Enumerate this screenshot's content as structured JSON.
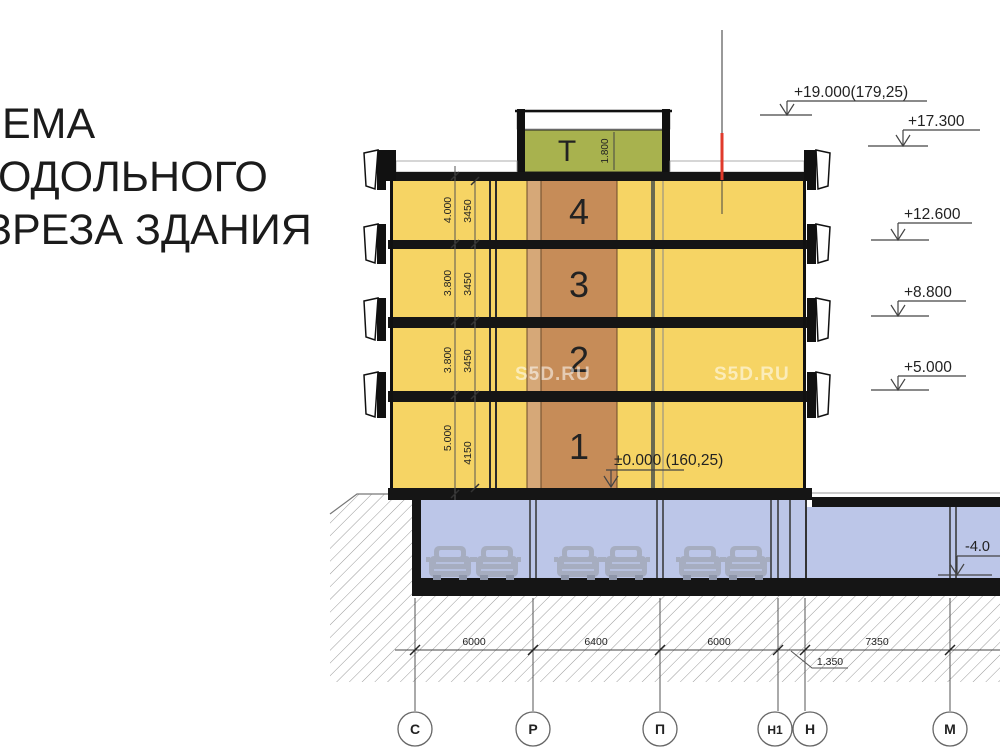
{
  "title": {
    "line1": "ЕМА",
    "line2": "ОДОЛЬНОГО",
    "line3": "ЗРЕЗА ЗДАНИЯ"
  },
  "watermark": {
    "text": "S5D.RU"
  },
  "building": {
    "tech_floor_label": "Т",
    "tech_floor_height": "1.800",
    "floors": [
      {
        "number": "4",
        "height_outer": "4.000",
        "height_inner": "3450"
      },
      {
        "number": "3",
        "height_outer": "3.800",
        "height_inner": "3450"
      },
      {
        "number": "2",
        "height_outer": "3.800",
        "height_inner": "3450"
      },
      {
        "number": "1",
        "height_outer": "5.000",
        "height_inner": "4150"
      }
    ]
  },
  "elevation_marks": {
    "roof_top": "+19.000(179,25)",
    "parapet": "+17.300",
    "level3": "+12.600",
    "level2": "+8.800",
    "level1": "+5.000",
    "ground": "±0.000 (160,25)",
    "basement": "-4.0"
  },
  "axes": {
    "labels": [
      "С",
      "Р",
      "П",
      "Н1",
      "Н",
      "М"
    ]
  },
  "dimensions": {
    "spans": [
      "6000",
      "6400",
      "6000",
      "7350"
    ],
    "offset": "1.350"
  },
  "colors": {
    "floor_yellow": "#F6D464",
    "shaft_brown": "#C68C58",
    "shaft_light": "#D6A878",
    "tech_green": "#A8B24E",
    "parking_blue": "#BCC6E8",
    "slab_black": "#151515",
    "marker_red": "#E03A2B"
  }
}
